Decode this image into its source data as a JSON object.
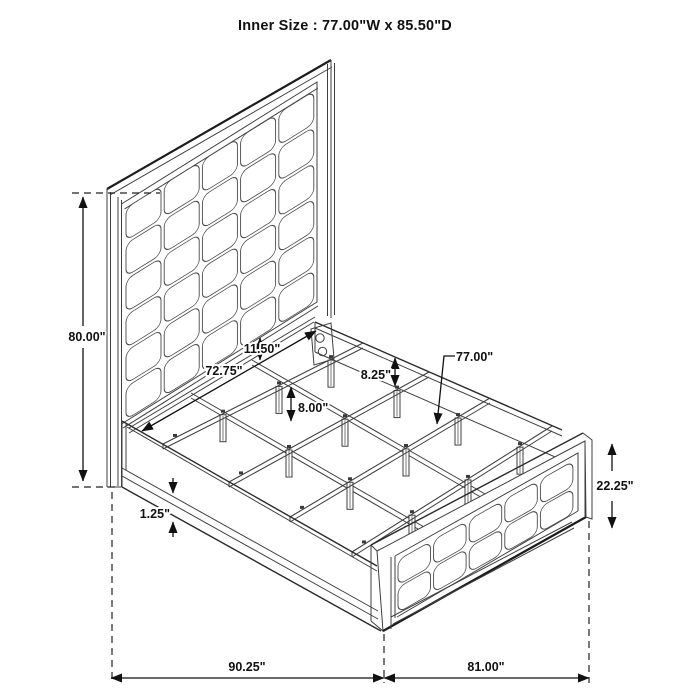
{
  "title": "Inner Size : 77.00\"W x 85.50\"D",
  "dimensions": {
    "headboard_height": "80.00\"",
    "inner_width_headboard": "72.75\"",
    "panel_to_rail_gap": "11.50\"",
    "side_rail_height": "8.25\"",
    "support_leg_height": "8.00\"",
    "slat_length": "77.00\"",
    "footboard_height": "22.25\"",
    "rail_lip_thickness": "1.25\"",
    "overall_depth": "90.25\"",
    "overall_width": "81.00\""
  }
}
